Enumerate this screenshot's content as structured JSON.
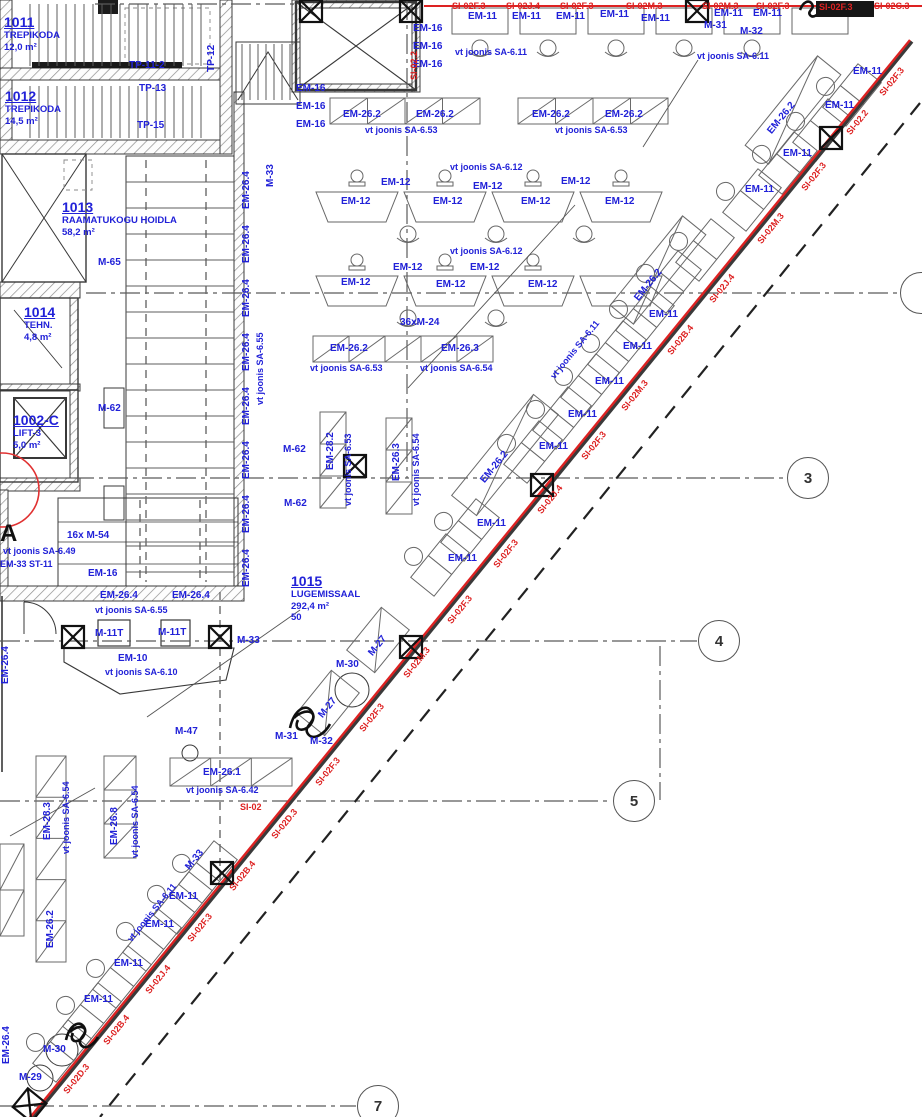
{
  "palette": {
    "blue": "#2121d8",
    "red": "#dd2222",
    "ink": "#2a2a2a",
    "grid": "#5a5a5a"
  },
  "marker_a": {
    "t": "A",
    "x": 0,
    "y": 520
  },
  "rooms": [
    {
      "id": "1011",
      "lines": [
        "TREPIKODA",
        "12,0 m²"
      ],
      "x": 4,
      "y": 15
    },
    {
      "id": "1012",
      "lines": [
        "TREPIKODA",
        "14,5 m²"
      ],
      "x": 5,
      "y": 89
    },
    {
      "id": "1013",
      "lines": [
        "RAAMATUKOGU HOIDLA",
        "58,2 m²"
      ],
      "x": 62,
      "y": 200
    },
    {
      "id": "1014",
      "lines": [
        "TEHN.",
        "4,8 m²"
      ],
      "x": 24,
      "y": 305
    },
    {
      "id": "1002-C",
      "lines": [
        "LIFT-3",
        "5,0 m²"
      ],
      "x": 13,
      "y": 413
    },
    {
      "id": "1015",
      "lines": [
        "LUGEMISSAAL",
        "292,4 m²",
        "50"
      ],
      "x": 291,
      "y": 574
    }
  ],
  "grid_bubbles": [
    {
      "n": "3",
      "x": 808,
      "y": 478
    },
    {
      "n": "4",
      "x": 719,
      "y": 641
    },
    {
      "n": "5",
      "x": 634,
      "y": 801
    },
    {
      "n": "7",
      "x": 378,
      "y": 1106
    },
    {
      "n": "",
      "x": 921,
      "y": 293
    }
  ],
  "labels_blue": [
    {
      "t": "EM-16",
      "x": 413,
      "y": 24
    },
    {
      "t": "EM-16",
      "x": 413,
      "y": 42
    },
    {
      "t": "EM-16",
      "x": 413,
      "y": 60
    },
    {
      "t": "EM-16",
      "x": 296,
      "y": 84
    },
    {
      "t": "EM-16",
      "x": 296,
      "y": 102
    },
    {
      "t": "EM-16",
      "x": 296,
      "y": 120
    },
    {
      "t": "EM-11",
      "x": 468,
      "y": 12
    },
    {
      "t": "EM-11",
      "x": 512,
      "y": 12
    },
    {
      "t": "EM-11",
      "x": 556,
      "y": 12
    },
    {
      "t": "EM-11",
      "x": 600,
      "y": 10
    },
    {
      "t": "EM-11",
      "x": 641,
      "y": 14
    },
    {
      "t": "EM-11",
      "x": 714,
      "y": 9
    },
    {
      "t": "EM-11",
      "x": 753,
      "y": 9
    },
    {
      "t": "vt joonis SA-6.11",
      "x": 455,
      "y": 48,
      "s": 1
    },
    {
      "t": "vt joonis SA-6.11",
      "x": 697,
      "y": 52,
      "s": 1
    },
    {
      "t": "M-31",
      "x": 704,
      "y": 21
    },
    {
      "t": "M-32",
      "x": 740,
      "y": 27
    },
    {
      "t": "EM-26.2",
      "x": 343,
      "y": 110
    },
    {
      "t": "EM-26.2",
      "x": 416,
      "y": 110
    },
    {
      "t": "EM-26.2",
      "x": 532,
      "y": 110
    },
    {
      "t": "EM-26.2",
      "x": 605,
      "y": 110
    },
    {
      "t": "vt joonis SA-6.53",
      "x": 365,
      "y": 126,
      "s": 1
    },
    {
      "t": "vt joonis SA-6.53",
      "x": 555,
      "y": 126,
      "s": 1
    },
    {
      "t": "vt joonis SA-6.12",
      "x": 450,
      "y": 163,
      "s": 1
    },
    {
      "t": "EM-12",
      "x": 381,
      "y": 178
    },
    {
      "t": "EM-12",
      "x": 473,
      "y": 182
    },
    {
      "t": "EM-12",
      "x": 561,
      "y": 177
    },
    {
      "t": "EM-12",
      "x": 341,
      "y": 197
    },
    {
      "t": "EM-12",
      "x": 433,
      "y": 197
    },
    {
      "t": "EM-12",
      "x": 521,
      "y": 197
    },
    {
      "t": "EM-12",
      "x": 605,
      "y": 197
    },
    {
      "t": "vt joonis SA-6.12",
      "x": 450,
      "y": 247,
      "s": 1
    },
    {
      "t": "EM-12",
      "x": 393,
      "y": 263
    },
    {
      "t": "EM-12",
      "x": 470,
      "y": 263
    },
    {
      "t": "EM-12",
      "x": 341,
      "y": 278
    },
    {
      "t": "EM-12",
      "x": 436,
      "y": 280
    },
    {
      "t": "EM-12",
      "x": 528,
      "y": 280
    },
    {
      "t": "36xM-24",
      "x": 400,
      "y": 318
    },
    {
      "t": "M-65",
      "x": 98,
      "y": 258
    },
    {
      "t": "M-62",
      "x": 98,
      "y": 404
    },
    {
      "t": "M-62",
      "x": 283,
      "y": 445
    },
    {
      "t": "M-62",
      "x": 284,
      "y": 499
    },
    {
      "t": "EM-26.2",
      "x": 330,
      "y": 344
    },
    {
      "t": "EM-26.3",
      "x": 441,
      "y": 344
    },
    {
      "t": "vt joonis SA-6.53",
      "x": 310,
      "y": 364,
      "s": 1
    },
    {
      "t": "vt joonis SA-6.54",
      "x": 420,
      "y": 364,
      "s": 1
    },
    {
      "t": "16x M-54",
      "x": 67,
      "y": 531
    },
    {
      "t": "vt joonis SA-6.49",
      "x": 3,
      "y": 547,
      "s": 1
    },
    {
      "t": "EM-33 ST-11",
      "x": 0,
      "y": 560,
      "s": 1
    },
    {
      "t": "EM-16",
      "x": 88,
      "y": 569
    },
    {
      "t": "EM-26.4",
      "x": 100,
      "y": 591
    },
    {
      "t": "EM-26.4",
      "x": 172,
      "y": 591
    },
    {
      "t": "vt joonis SA-6.55",
      "x": 95,
      "y": 606,
      "s": 1
    },
    {
      "t": "M-11T",
      "x": 95,
      "y": 629
    },
    {
      "t": "M-11T",
      "x": 158,
      "y": 628
    },
    {
      "t": "M-33",
      "x": 237,
      "y": 636
    },
    {
      "t": "EM-10",
      "x": 118,
      "y": 654
    },
    {
      "t": "vt joonis SA-6.10",
      "x": 105,
      "y": 668,
      "s": 1
    },
    {
      "t": "M-47",
      "x": 175,
      "y": 727
    },
    {
      "t": "EM-26.1",
      "x": 203,
      "y": 768
    },
    {
      "t": "vt joonis SA-6.42",
      "x": 186,
      "y": 786,
      "s": 1
    },
    {
      "t": "M-30",
      "x": 336,
      "y": 660
    },
    {
      "t": "M-31",
      "x": 275,
      "y": 732
    },
    {
      "t": "M-32",
      "x": 310,
      "y": 737
    },
    {
      "t": "EM-11",
      "x": 853,
      "y": 67
    },
    {
      "t": "EM-11",
      "x": 825,
      "y": 101
    },
    {
      "t": "EM-11",
      "x": 783,
      "y": 149
    },
    {
      "t": "EM-11",
      "x": 745,
      "y": 185
    },
    {
      "t": "EM-11",
      "x": 649,
      "y": 310
    },
    {
      "t": "EM-11",
      "x": 623,
      "y": 342
    },
    {
      "t": "EM-11",
      "x": 595,
      "y": 377
    },
    {
      "t": "EM-11",
      "x": 568,
      "y": 410
    },
    {
      "t": "EM-11",
      "x": 539,
      "y": 442
    },
    {
      "t": "EM-11",
      "x": 477,
      "y": 519
    },
    {
      "t": "EM-11",
      "x": 448,
      "y": 554
    },
    {
      "t": "EM-11",
      "x": 169,
      "y": 892
    },
    {
      "t": "EM-11",
      "x": 145,
      "y": 920
    },
    {
      "t": "EM-11",
      "x": 114,
      "y": 959
    },
    {
      "t": "EM-11",
      "x": 84,
      "y": 995
    },
    {
      "t": "M-30",
      "x": 43,
      "y": 1045
    },
    {
      "t": "M-29",
      "x": 19,
      "y": 1073
    },
    {
      "t": "TP-11-2",
      "x": 129,
      "y": 61
    },
    {
      "t": "TP-13",
      "x": 139,
      "y": 84
    },
    {
      "t": "TP-15",
      "x": 137,
      "y": 121
    },
    {
      "t": "TP-12",
      "x": 207,
      "y": 72,
      "r": "v"
    },
    {
      "t": "M-33",
      "x": 266,
      "y": 187,
      "r": "v"
    },
    {
      "t": "EM-26.4",
      "x": 242,
      "y": 209,
      "r": "v"
    },
    {
      "t": "EM-26.4",
      "x": 242,
      "y": 263,
      "r": "v"
    },
    {
      "t": "EM-26.4",
      "x": 242,
      "y": 317,
      "r": "v"
    },
    {
      "t": "EM-26.4",
      "x": 242,
      "y": 371,
      "r": "v"
    },
    {
      "t": "EM-26.4",
      "x": 242,
      "y": 425,
      "r": "v"
    },
    {
      "t": "EM-26.4",
      "x": 242,
      "y": 479,
      "r": "v"
    },
    {
      "t": "EM-26.4",
      "x": 242,
      "y": 533,
      "r": "v"
    },
    {
      "t": "EM-26.4",
      "x": 242,
      "y": 587,
      "r": "v"
    },
    {
      "t": "vt joonis SA-6.55",
      "x": 256,
      "y": 405,
      "r": "v",
      "s": 1
    },
    {
      "t": "EM-28.2",
      "x": 326,
      "y": 470,
      "r": "v"
    },
    {
      "t": "vt joonis SA-6.53",
      "x": 344,
      "y": 506,
      "r": "v",
      "s": 1
    },
    {
      "t": "EM-26.3",
      "x": 392,
      "y": 481,
      "r": "v"
    },
    {
      "t": "vt joonis SA-6.54",
      "x": 412,
      "y": 506,
      "r": "v",
      "s": 1
    },
    {
      "t": "EM-26.4",
      "x": 1,
      "y": 684,
      "r": "v"
    },
    {
      "t": "EM-28.3",
      "x": 43,
      "y": 840,
      "r": "v"
    },
    {
      "t": "vt joonis SA-6.54",
      "x": 62,
      "y": 854,
      "r": "v",
      "s": 1
    },
    {
      "t": "EM-26.8",
      "x": 110,
      "y": 845,
      "r": "v"
    },
    {
      "t": "vt joonis SA-6.54",
      "x": 131,
      "y": 858,
      "r": "v",
      "s": 1
    },
    {
      "t": "EM-26.2",
      "x": 46,
      "y": 948,
      "r": "v"
    },
    {
      "t": "EM-26.4",
      "x": 2,
      "y": 1064,
      "r": "v"
    },
    {
      "t": "EM-26.2",
      "x": 766,
      "y": 130,
      "r": "d"
    },
    {
      "t": "EM-26.2",
      "x": 633,
      "y": 297,
      "r": "d"
    },
    {
      "t": "EM-26.2",
      "x": 479,
      "y": 479,
      "r": "d"
    },
    {
      "t": "vt joonis SA-6.11",
      "x": 549,
      "y": 375,
      "r": "d",
      "s": 1
    },
    {
      "t": "M-27",
      "x": 367,
      "y": 652,
      "r": "d"
    },
    {
      "t": "M-27",
      "x": 317,
      "y": 714,
      "r": "d"
    },
    {
      "t": "M-33",
      "x": 184,
      "y": 866,
      "r": "d"
    },
    {
      "t": "vt joonis SA-6.11",
      "x": 126,
      "y": 938,
      "r": "d",
      "s": 1
    }
  ],
  "labels_red": [
    {
      "t": "SI-02F.3",
      "x": 452,
      "y": 2,
      "s": 1
    },
    {
      "t": "SI-02J.4",
      "x": 506,
      "y": 2,
      "s": 1
    },
    {
      "t": "SI-02F.3",
      "x": 560,
      "y": 2,
      "s": 1
    },
    {
      "t": "SI-02M.3",
      "x": 626,
      "y": 2,
      "s": 1
    },
    {
      "t": "SI-02M.3",
      "x": 702,
      "y": 2,
      "s": 1
    },
    {
      "t": "SI-02F.3",
      "x": 756,
      "y": 2,
      "s": 1
    },
    {
      "t": "SI-02F.3",
      "x": 819,
      "y": 3,
      "s": 1
    },
    {
      "t": "SI-02C.3",
      "x": 874,
      "y": 2,
      "s": 1
    },
    {
      "t": "SI-02.2",
      "x": 410,
      "y": 80,
      "r": "v",
      "s": 1
    },
    {
      "t": "SI-02",
      "x": 240,
      "y": 803,
      "s": 1
    }
  ],
  "labels_red_diag": [
    {
      "t": "SI-02F.3",
      "x": 878,
      "y": 92
    },
    {
      "t": "SI-02.2",
      "x": 845,
      "y": 131
    },
    {
      "t": "SI-02F.3",
      "x": 800,
      "y": 187
    },
    {
      "t": "SI-02M.3",
      "x": 756,
      "y": 240
    },
    {
      "t": "SI-02J.4",
      "x": 708,
      "y": 299
    },
    {
      "t": "SI-02B.4",
      "x": 666,
      "y": 351
    },
    {
      "t": "SI-02M.3",
      "x": 620,
      "y": 407
    },
    {
      "t": "SI-02F.3",
      "x": 580,
      "y": 456
    },
    {
      "t": "SI-02J.4",
      "x": 536,
      "y": 510
    },
    {
      "t": "SI-02F.3",
      "x": 492,
      "y": 564
    },
    {
      "t": "SI-02F.3",
      "x": 446,
      "y": 620
    },
    {
      "t": "SI-02M.3",
      "x": 402,
      "y": 674
    },
    {
      "t": "SI-02F.3",
      "x": 358,
      "y": 728
    },
    {
      "t": "SI-02F.3",
      "x": 314,
      "y": 782
    },
    {
      "t": "SI-02D.3",
      "x": 270,
      "y": 835
    },
    {
      "t": "SI-02B.4",
      "x": 228,
      "y": 887
    },
    {
      "t": "SI-02F.3",
      "x": 186,
      "y": 938
    },
    {
      "t": "SI-02J.4",
      "x": 144,
      "y": 990
    },
    {
      "t": "SI-02B.4",
      "x": 102,
      "y": 1041
    },
    {
      "t": "SI-02D.3",
      "x": 62,
      "y": 1090
    }
  ]
}
